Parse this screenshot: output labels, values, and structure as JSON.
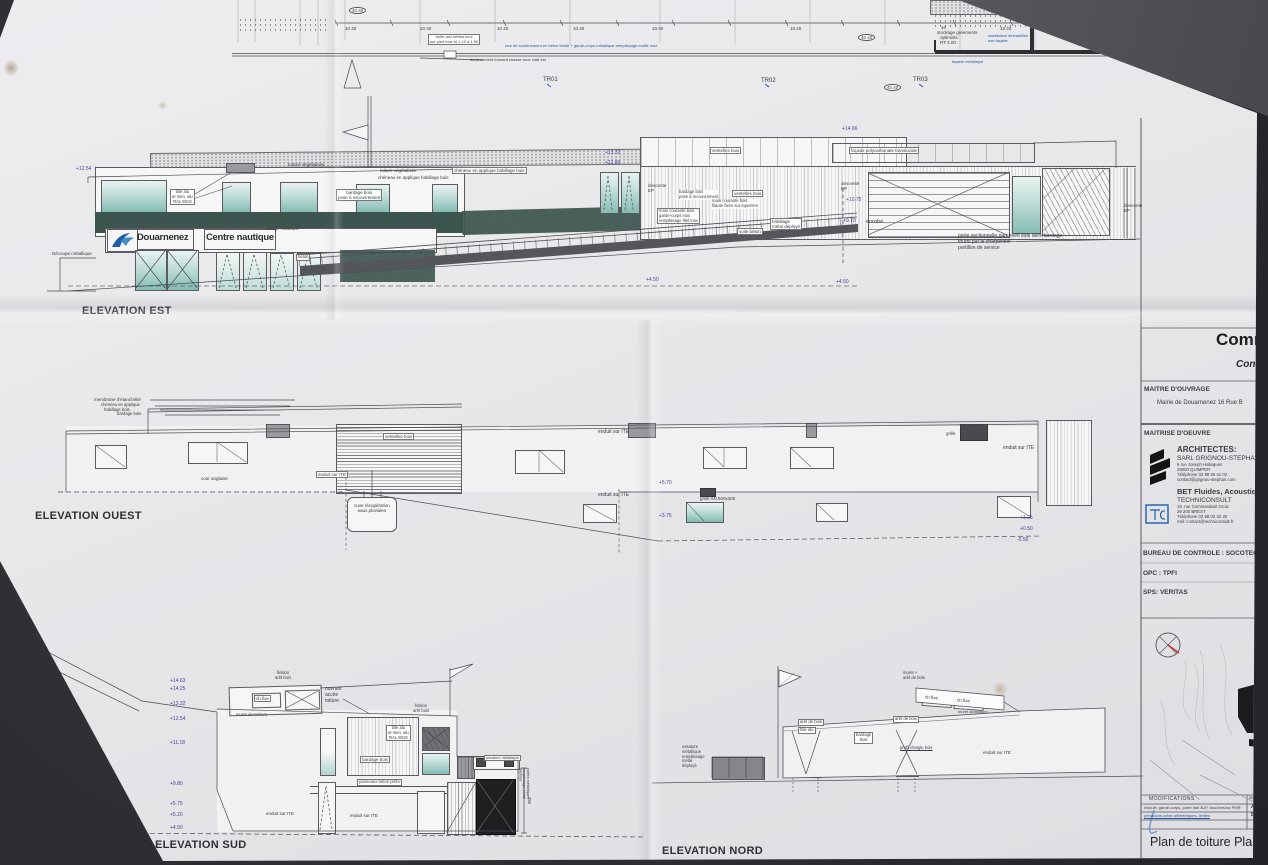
{
  "top_plan": {
    "tr1": "TR01",
    "tr2": "TR02",
    "tr3": "TR03",
    "dim": "10.40",
    "bubble": "40.40",
    "boite_l1": "boîte aux lettres inox",
    "boite_l2": "sur pied inox ht 1.10 à 1.50",
    "mur": "mur de soutènement en béton teinté + garde-corps métallique remplissage maille inox",
    "chasse": "soutènement formant chasse roue côté est",
    "stock_l1": "10",
    "stock_l2": "stockage gréements",
    "stock_l3": "optimists",
    "stock_l4": "RT 4.00",
    "facade": "façade métallique",
    "inst_l1": "installation déshabillés",
    "inst_l2": "axe façade"
  },
  "est": {
    "title": "ELEVATION EST",
    "sign_city": "Douarnenez",
    "sign_centre": "Centre nautique",
    "toiture": "toiture végétalisée",
    "cheneau": "chéneau en applique habillage bois",
    "tole_l1": "tôle alu",
    "tole_l2": "et men. alu",
    "tole_l3": "RAL 8019",
    "bardage_l1": "bardage bois",
    "bardage_l2": "pose à recouvrement",
    "ventelles": "ventelles bois",
    "polycarbonate": "façade polycarbonate translucide",
    "descente_l1": "descente",
    "descente_l2": "EP",
    "mc1_l1": "main courante bois",
    "mc1_l2": "filante fixée sur équerres",
    "mc2_l1": "main courante bois",
    "mc2_l2": "garde-corps inox",
    "mc2_l3": "remplissage filet inox",
    "habillage_l1": "habillage",
    "habillage_l2": "métal déployé",
    "voile": "voile béton",
    "beton": "béton",
    "lettrage": "lettrage métallique",
    "decoupe": "Découpe métallique",
    "enrobe": "enrobé",
    "porte_l1": "porte sectionnelle parement bois idem bardage",
    "porte_l2": "fourni par le charpentier",
    "porte_l3": "portillon de service",
    "lv_1466": "+14.66",
    "lv_1332": "+13.32",
    "lv_1289": "+12.89",
    "lv_1254": "+12.54",
    "lv_1075": "+10.75",
    "lv_970": "+9.70",
    "lv_450": "+4.50"
  },
  "ouest": {
    "title": "ELEVATION OUEST",
    "membrane": "membrane d'étanchéité",
    "cheneau_l1": "chéneau en applique",
    "cheneau_l2": "habillage bois",
    "bardage": "bardage bois",
    "cour": "cour anglaise",
    "ventelles": "ventelles bois",
    "enduit": "enduit sur ITE",
    "cuve_l1": "cuve récupération",
    "cuve_l2": "eaux pluviales",
    "grille_an": "grille AN 600x300",
    "grille": "grille",
    "lv_570": "+5.70",
    "lv_375": "+3.75",
    "lv_125": "+1.25",
    "lv_050": "+0.50",
    "lv_m050": "-0.50"
  },
  "sud": {
    "title": "ELEVATION SUD",
    "finition_l1": "finition",
    "finition_l2": "arêt bois",
    "chfixe": "ch.fixe",
    "ouvrant_l1": "ouvrant",
    "ouvrant_l2": "accès",
    "ouvrant_l3": "toiture",
    "muret_alu": "muret aluminium",
    "tole_l1": "tôle alu",
    "tole_l2": "et men. alu",
    "tole_l3": "RAL 8019",
    "bardage": "bardage bois",
    "panneaux": "panneaux béton préfa",
    "enduit": "enduit sur ITE",
    "ossature": "ossature métallique",
    "portes_vert": "portes métalliques remplissage métal déployé",
    "dim350": "350",
    "levels": [
      "+14.63",
      "+14.25",
      "+13.32",
      "+12.54",
      "+11.18",
      "+9.80",
      "+5.75",
      "+5.20",
      "+4.50"
    ]
  },
  "nord": {
    "title": "ELEVATION NORD",
    "ossature_l1": "ossature",
    "ossature_l2": "métallique",
    "ossature_l3": "remplissage",
    "ossature_l4": "métal",
    "ossature_l5": "déployé",
    "aret": "arêt de bois",
    "tole": "tôle alu",
    "bardage_l1": "bardage",
    "bardage_l2": "bois",
    "profil": "profil d'angle bois",
    "muret_aret_l1": "muret +",
    "muret_aret_l2": "arêt de bois",
    "chfixe": "ch.fixe",
    "muret_alu": "muret aluminium",
    "enduit": "enduit sur ITE"
  },
  "title_block": {
    "project": "Comm",
    "project_sub": "Cons",
    "mo_label": "MAITRE D'OUVRAGE",
    "mo": "Mairie de Douarnenez 16 Rue B",
    "moe_label": "MAITRISE D'OEUVRE",
    "arch_label": "ARCHITECTES:",
    "arch_name": "SARL GRIGNOU-STEPHAN",
    "arch_addr1": "6 rue Joseph Halleguen",
    "arch_addr2": "29000 QUIMPER",
    "arch_tel": "Téléphone 02 98 55 41 02",
    "arch_mail": "contact@grignou-stephan.com",
    "bet_label": "BET Fluides, Acoustique",
    "bet_name": "TECHNICONSULT",
    "bet_addr1": "18, rue Commandant Groix",
    "bet_addr2": "29 200 BREST",
    "bet_tel": "Téléphone 02 98 02 32 30",
    "bet_mail": "mél: contact@techniconsult.fr",
    "tc": "TC",
    "controle": "BUREAU DE CONTROLE : SOCOTEC",
    "opc": "OPC : TPFI",
    "sps": "SPS: VERITAS",
    "mods_label": "MODIFICATIONS",
    "indice_label": "indice",
    "mods": [
      {
        "text": "édicule, garde-corps, porte hall 3UP, douches/wc PMR",
        "ind": "A"
      },
      {
        "text": "précisions cotes altimétriques, limites",
        "ind": "B"
      }
    ],
    "doc_title": "Plan de toiture Plans de"
  }
}
